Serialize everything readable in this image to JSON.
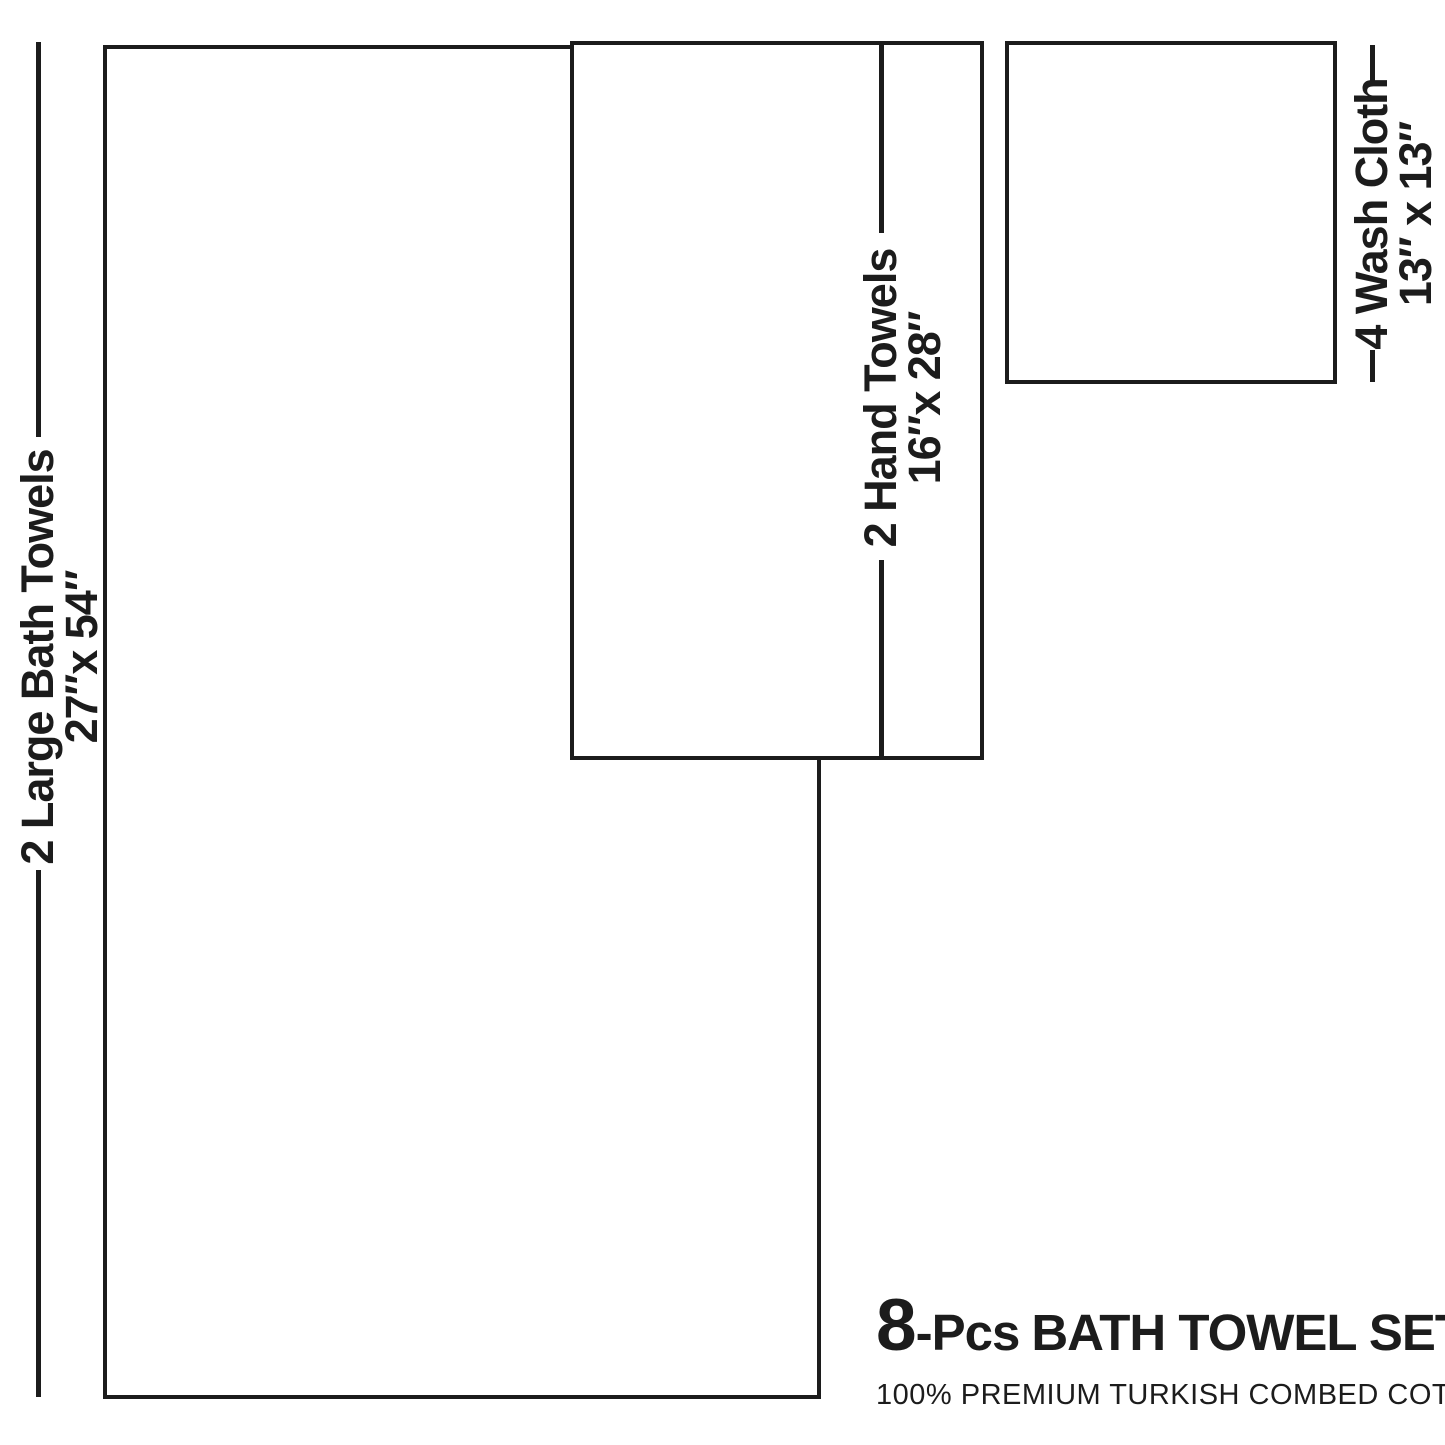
{
  "page": {
    "background_color": "#ffffff",
    "line_color": "#1c1c1c"
  },
  "items": [
    {
      "id": "large-bath-towels",
      "label": "2 Large Bath Towels",
      "size": "27″x 54″"
    },
    {
      "id": "hand-towels",
      "label": "2 Hand Towels",
      "size": "16″x 28″"
    },
    {
      "id": "wash-cloths",
      "label": "4 Wash Cloth",
      "size": "13″ x 13″"
    }
  ],
  "title": {
    "count": "8",
    "pcs": "-Pcs",
    "name": "BATH TOWEL SET",
    "subtitle": "100% PREMIUM TURKISH COMBED COTTON"
  }
}
